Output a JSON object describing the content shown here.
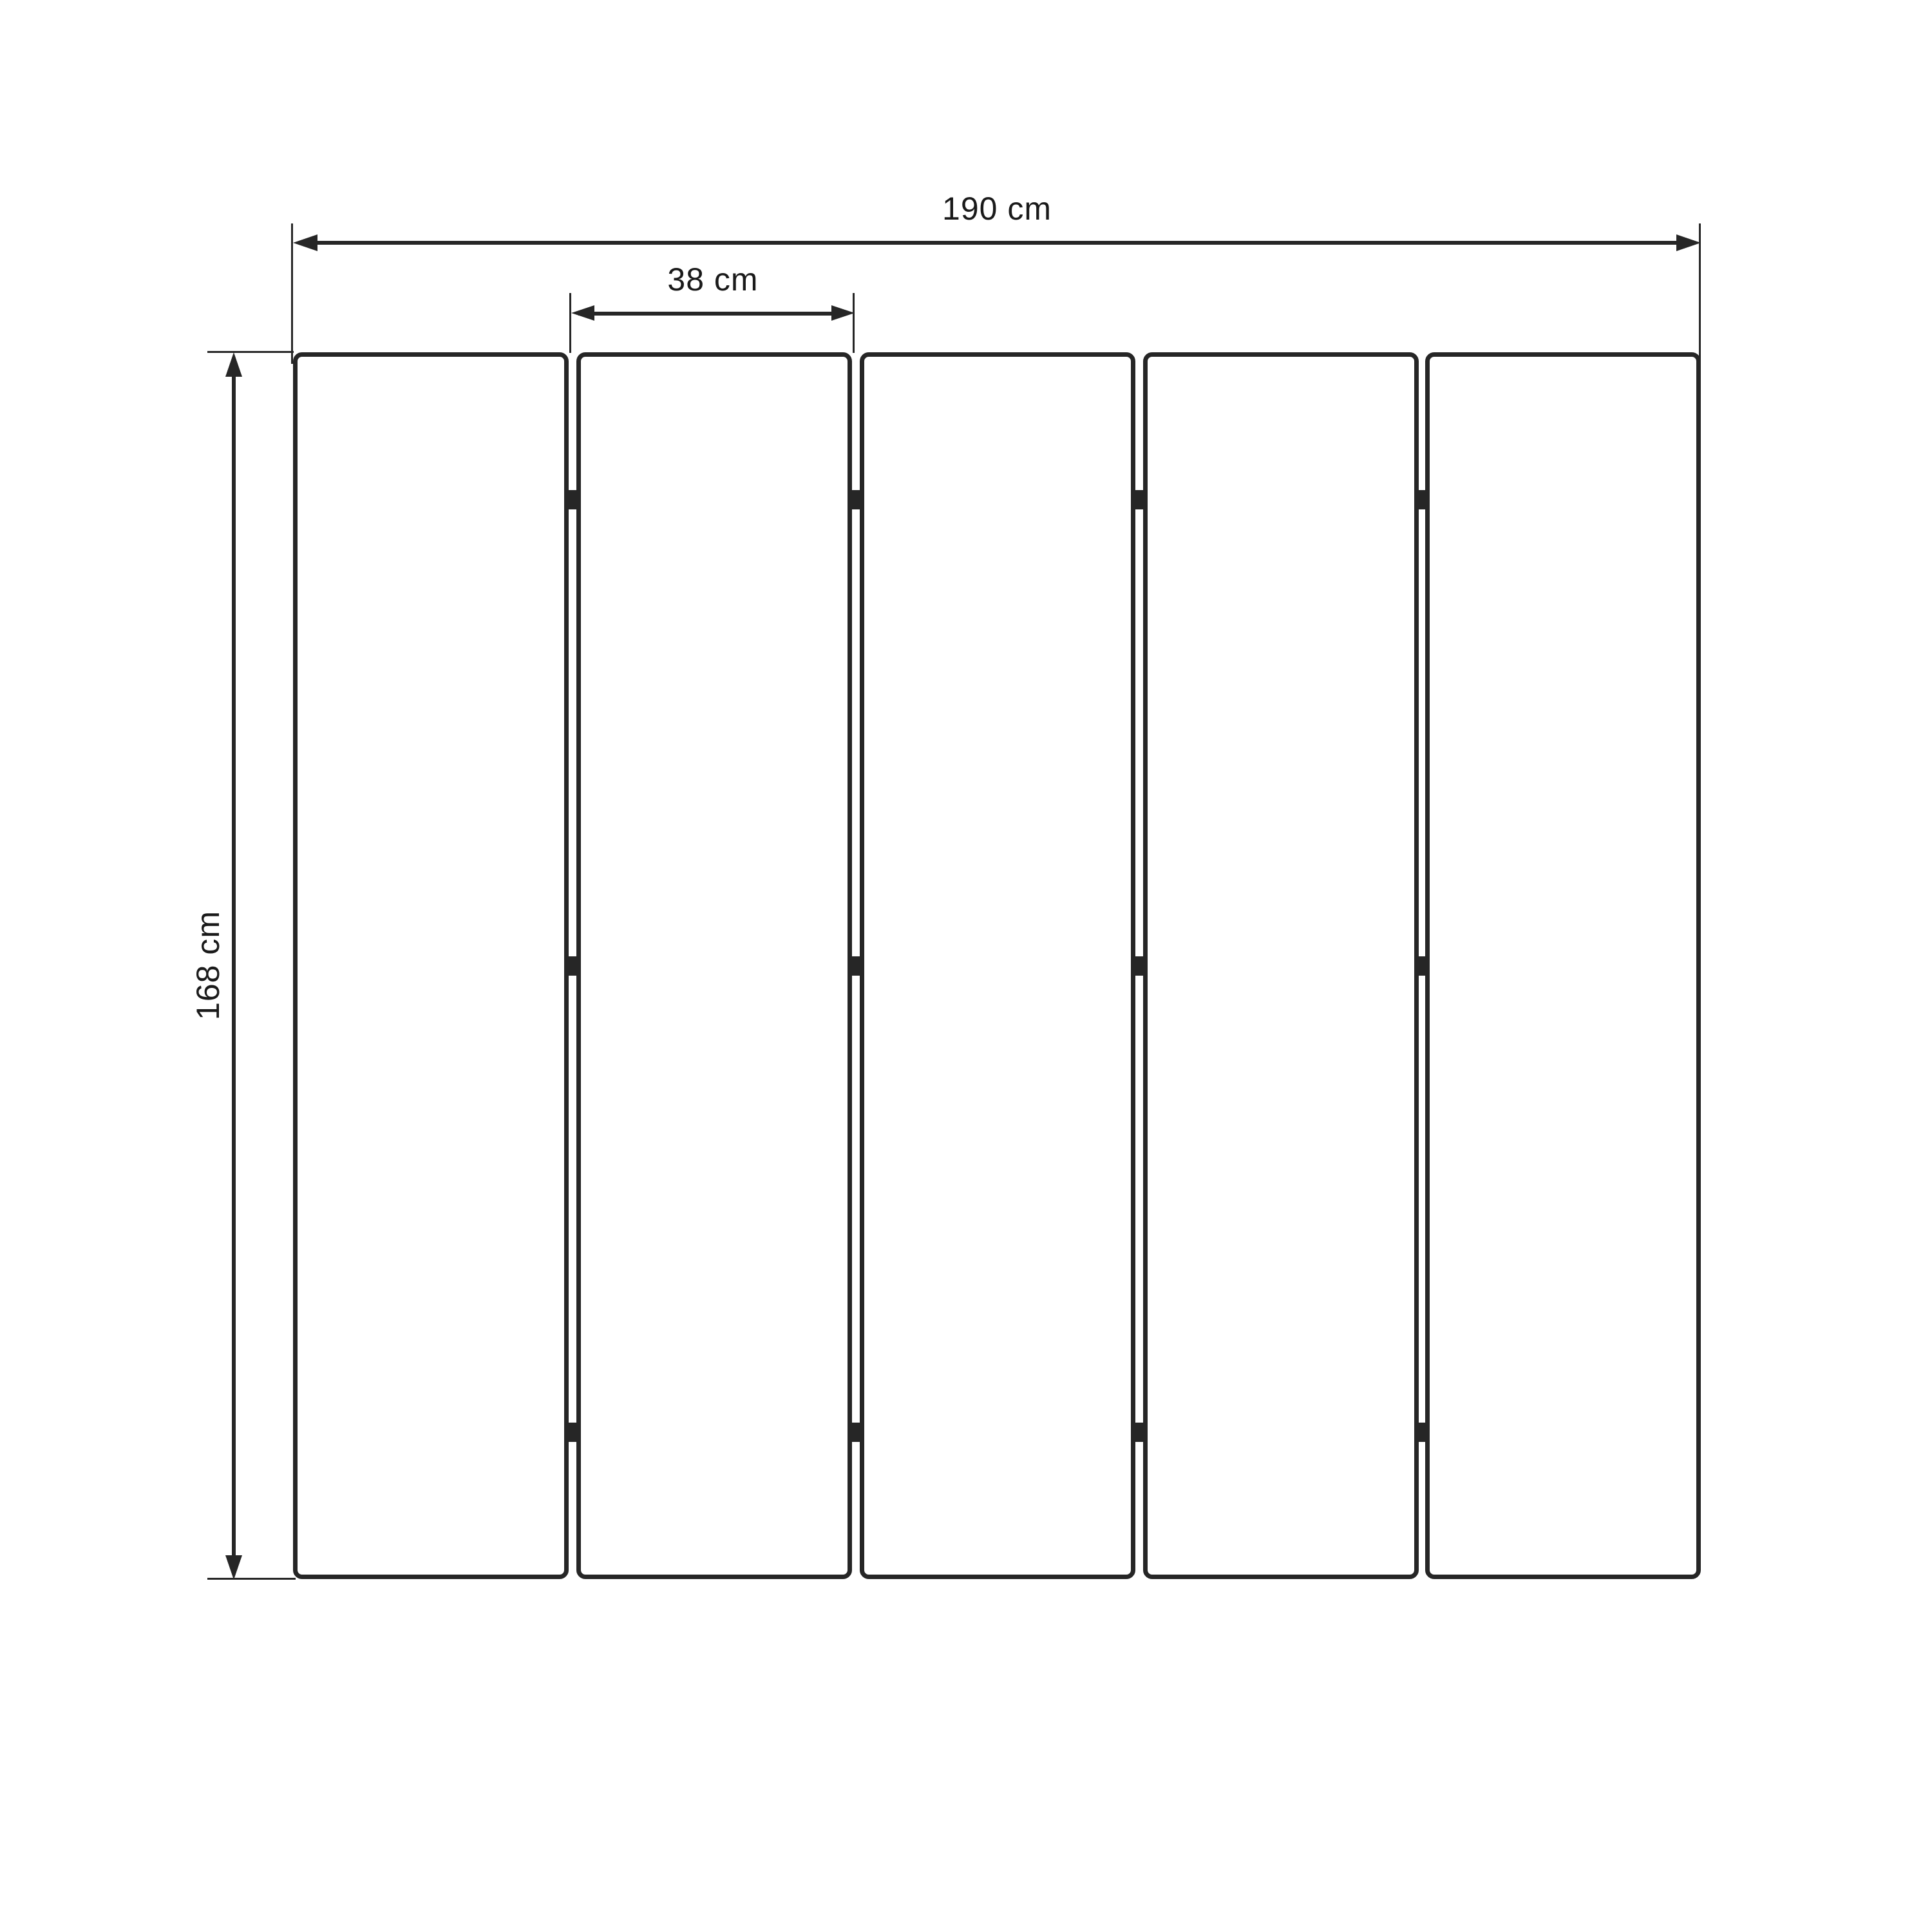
{
  "drawing": {
    "labels": {
      "total_width": "190 cm",
      "panel_width": "38 cm",
      "height": "168 cm"
    },
    "values": {
      "total_width_cm": 190,
      "panel_width_cm": 38,
      "height_cm": 168,
      "unit": "cm"
    },
    "panel_count": 5,
    "gap_count": 4,
    "hinge_rows_per_gap": 3,
    "colors": {
      "stroke": "#262626",
      "background": "#ffffff",
      "text": "#1a1a1a"
    }
  }
}
